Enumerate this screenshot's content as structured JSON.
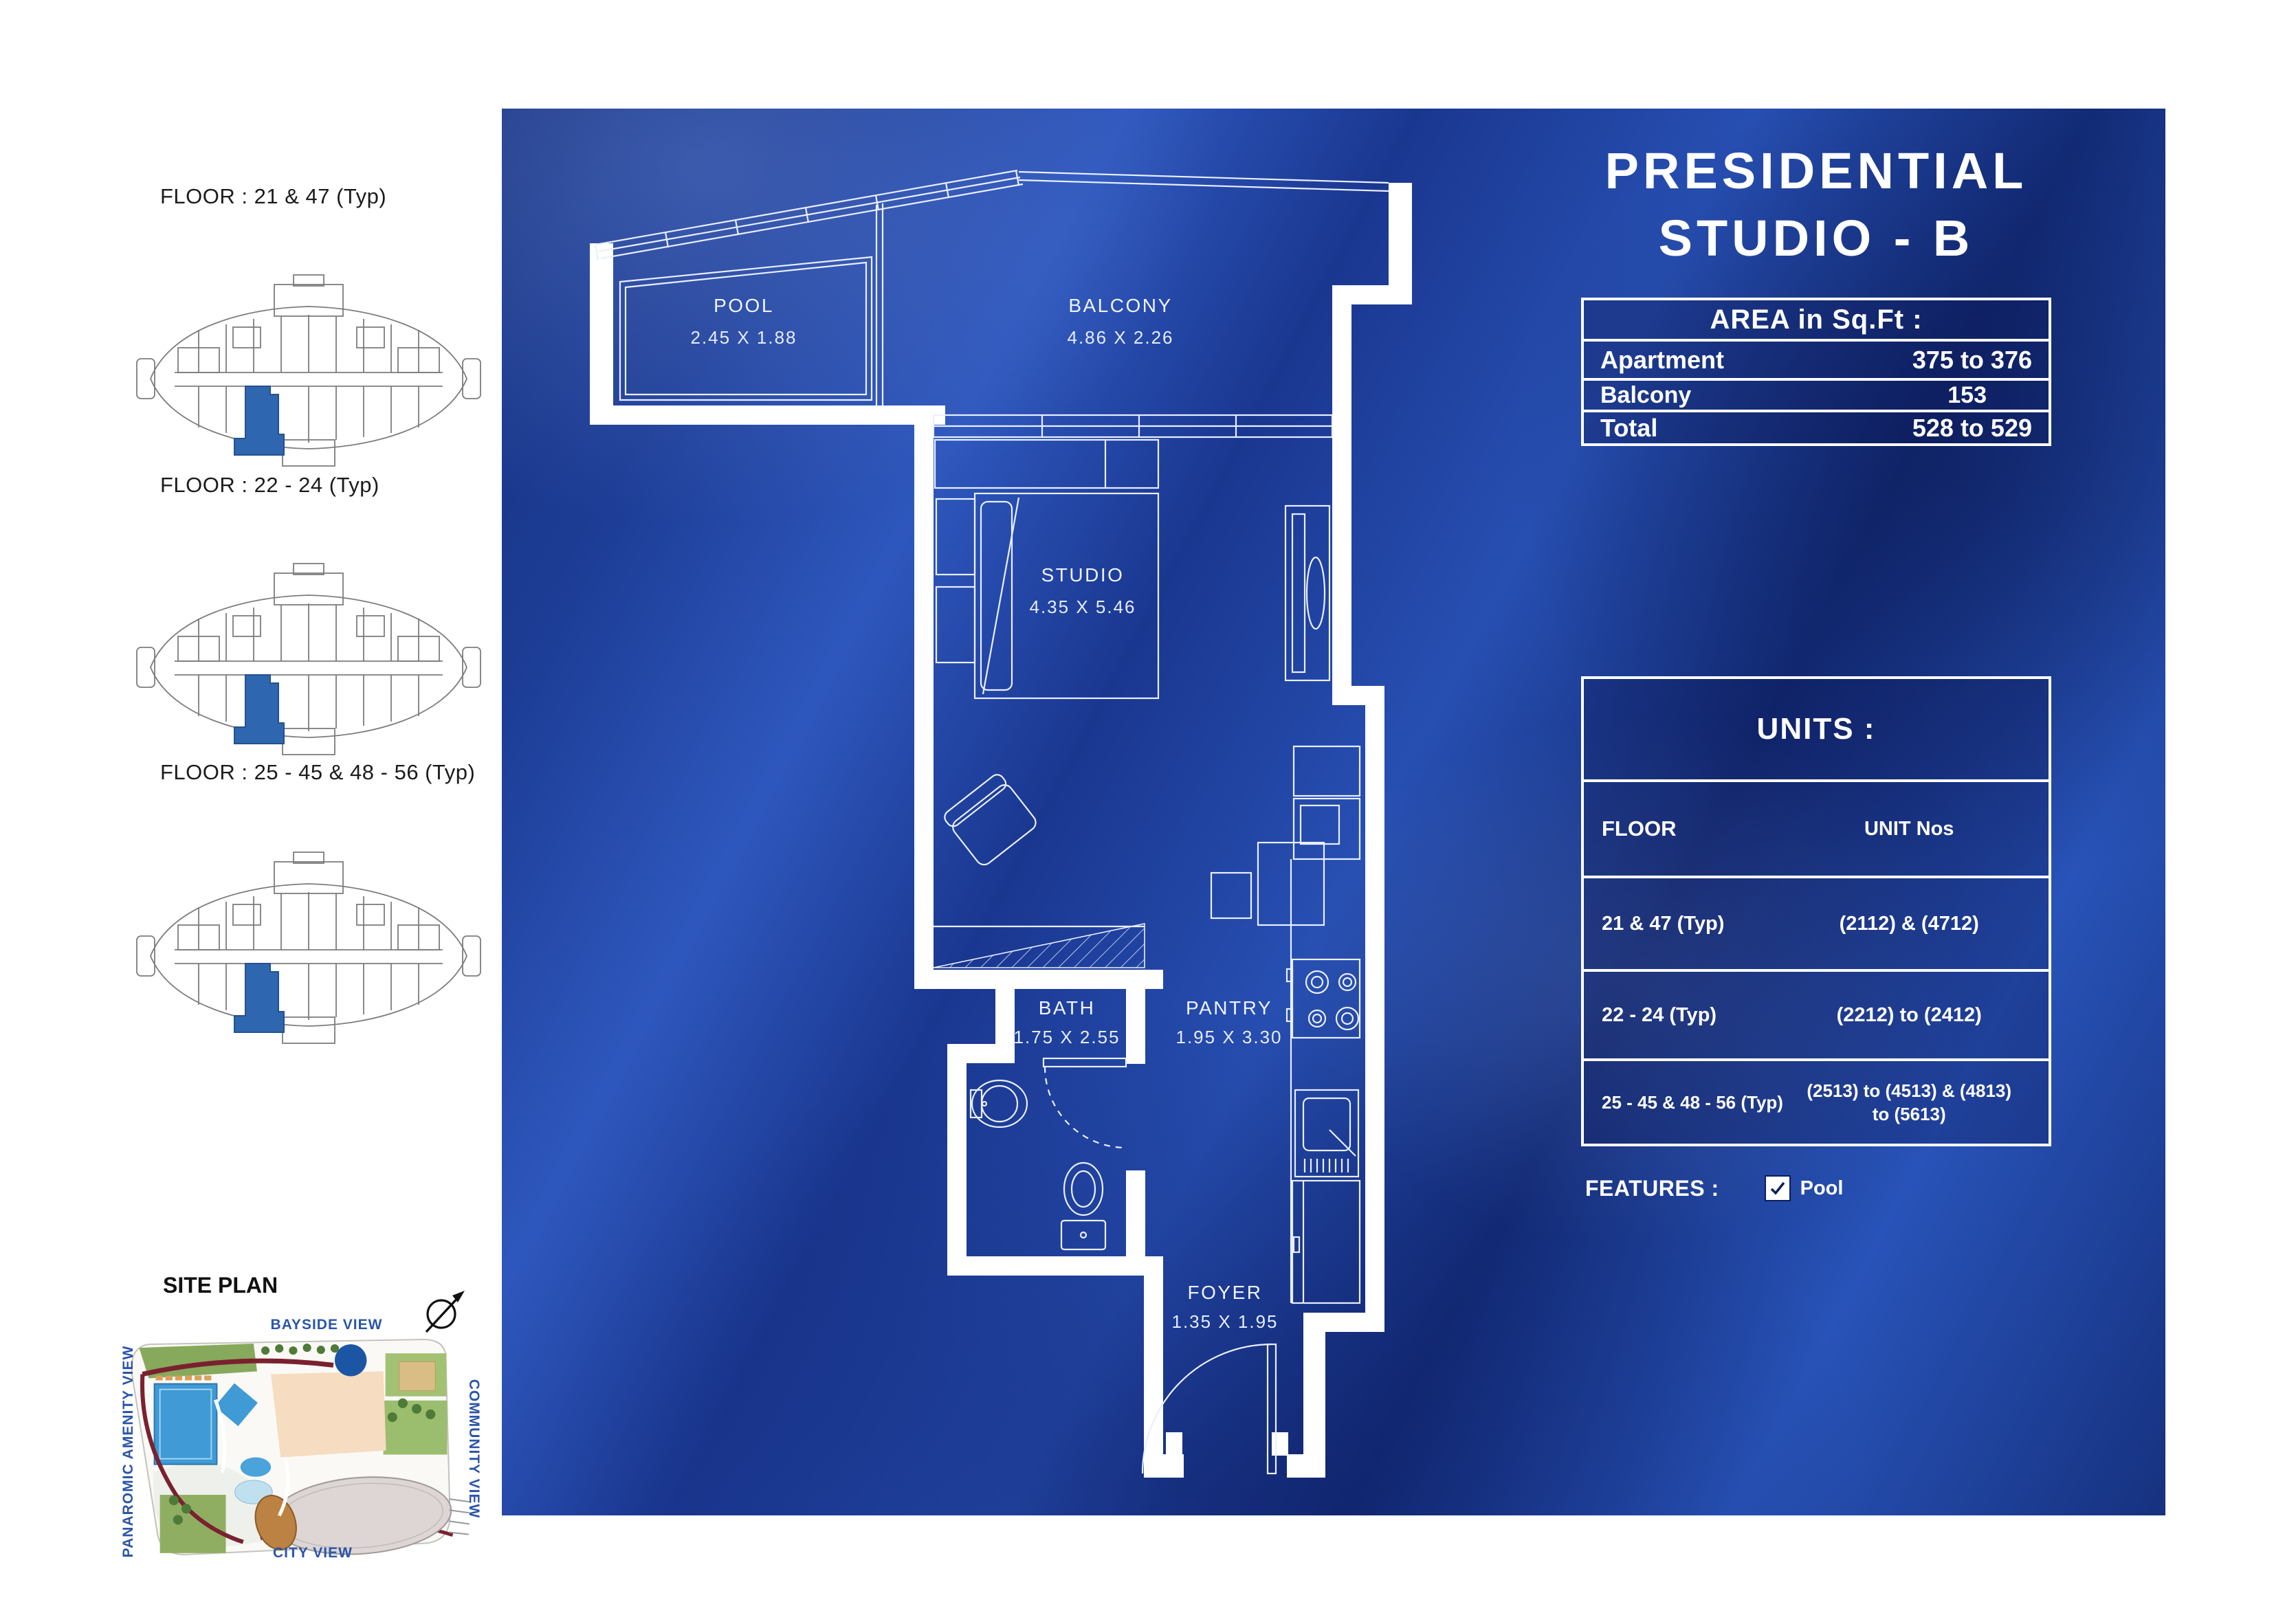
{
  "colors": {
    "panel_blue": "#1e3f9a",
    "plan_line": "#e9efff",
    "highlight_unit_blue": "#2f66b0",
    "view_label_blue": "#2b55a8",
    "site_border_maroon": "#7a2130"
  },
  "floor_keys": [
    {
      "label": "FLOOR : 21 & 47 (Typ)"
    },
    {
      "label": "FLOOR : 22 - 24 (Typ)"
    },
    {
      "label": "FLOOR : 25 - 45 & 48 - 56 (Typ)"
    }
  ],
  "site_plan": {
    "title": "SITE PLAN",
    "labels": {
      "top": "BAYSIDE VIEW",
      "left": "PANAROMIC AMENITY VIEW",
      "right": "COMMUNITY VIEW",
      "bottom": "CITY VIEW"
    }
  },
  "plan": {
    "rooms": [
      {
        "name": "POOL",
        "dims": "2.45 X 1.88"
      },
      {
        "name": "BALCONY",
        "dims": "4.86 X 2.26"
      },
      {
        "name": "STUDIO",
        "dims": "4.35 X 5.46"
      },
      {
        "name": "BATH",
        "dims": "1.75 X 2.55"
      },
      {
        "name": "PANTRY",
        "dims": "1.95 X 3.30"
      },
      {
        "name": "FOYER",
        "dims": "1.35 X 1.95"
      }
    ]
  },
  "title": {
    "line1": "PRESIDENTIAL",
    "line2": "STUDIO - B"
  },
  "area_table": {
    "header": "AREA in Sq.Ft :",
    "rows": [
      {
        "label": "Apartment",
        "value": "375 to 376"
      },
      {
        "label": "Balcony",
        "value": "153"
      },
      {
        "label": "Total",
        "value": "528 to 529"
      }
    ]
  },
  "units_table": {
    "header": "UNITS :",
    "col1": "FLOOR",
    "col2": "UNIT Nos",
    "rows": [
      {
        "floor": "21 & 47 (Typ)",
        "units": "(2112) & (4712)"
      },
      {
        "floor": "22 - 24 (Typ)",
        "units": "(2212) to (2412)"
      },
      {
        "floor": "25 - 45 & 48 - 56 (Typ)",
        "units": "(2513) to (4513) & (4813) to (5613)"
      }
    ]
  },
  "features": {
    "label": "FEATURES :",
    "items": [
      {
        "label": "Pool",
        "checked": true
      }
    ]
  }
}
